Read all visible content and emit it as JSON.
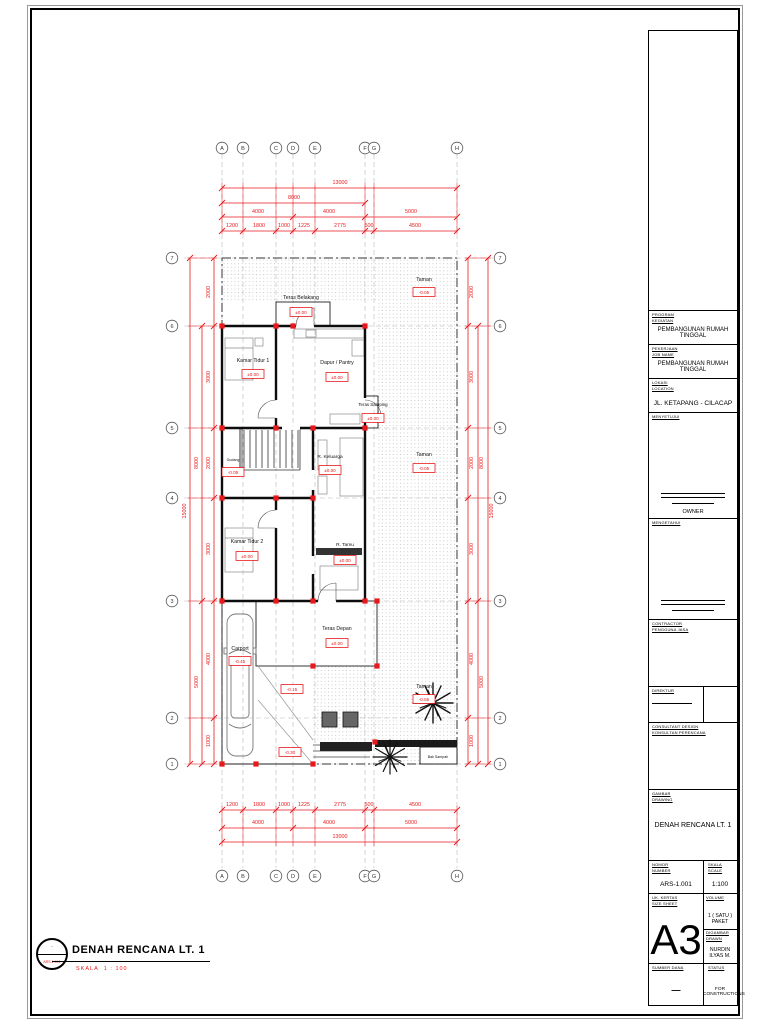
{
  "sheet": {
    "accent_red": "#e8191c",
    "paper": "#ffffff"
  },
  "footer": {
    "title": "DENAH RENCANA LT. 1",
    "scale_label": "SKALA",
    "scale_value": "1 : 100",
    "ref_top": "-",
    "ref_bottom": "ARS-1.001"
  },
  "title_block": {
    "program": {
      "label1": "PROGRAM",
      "label2": "KEGIATAN",
      "value": "PEMBANGUNAN RUMAH TINGGAL"
    },
    "pekerjaan": {
      "label1": "PEKERJAAN",
      "label2": "JOB NAME",
      "value": "PEMBANGUNAN RUMAH TINGGAL"
    },
    "lokasi": {
      "label1": "LOKASI",
      "label2": "LOCATION",
      "value": "JL. KETAPANG - CILACAP"
    },
    "menyetujui": {
      "label": "MENYETUJUI",
      "value": "OWNER"
    },
    "mengetahui": {
      "label": "MENGETAHUI"
    },
    "contractor": {
      "label1": "CONTRACTOR",
      "label2": "PENGGUNA JASA"
    },
    "direktur": {
      "label": "DIREKTUR"
    },
    "consultant": {
      "label1": "CONSULTANT DESIGN",
      "label2": "KONSULTAN PERENCANA"
    },
    "gambar": {
      "label1": "GAMBAR",
      "label2": "DRAWING",
      "value": "DENAH RENCANA LT. 1"
    },
    "nomor": {
      "label1": "NOMOR",
      "label2": "NUMBER",
      "value": "ARS-1.001"
    },
    "skala": {
      "label1": "SKALA",
      "label2": "SCALE",
      "value": "1:100"
    },
    "kertas": {
      "label1": "UK. KERTAS",
      "label2": "SIZE SHEET",
      "value": "A3"
    },
    "volume": {
      "label": "VOLUME",
      "value": "1 ( SATU ) PAKET"
    },
    "digambar": {
      "label1": "DIGAMBAR",
      "label2": "DRAWN",
      "value": "NURDIN ILYAS M."
    },
    "sumber_dana": {
      "label": "SUMBER DANA",
      "value": "—"
    },
    "status": {
      "label": "STATUS",
      "value": "FOR CONSTRUCTIONS"
    }
  },
  "plan": {
    "grid_cols": [
      "A",
      "B",
      "C",
      "D",
      "E",
      "F",
      "G",
      "H"
    ],
    "grid_rows": [
      "7",
      "6",
      "5",
      "4",
      "3",
      "2",
      "1"
    ],
    "dim_total_h": "13000",
    "dim_sub_h": "8000",
    "dims_mid_h": [
      "4000",
      "4000",
      "5000"
    ],
    "dims_detail_h": [
      "1200",
      "1800",
      "1000",
      "1225",
      "2775",
      "500",
      "4500"
    ],
    "dim_total_v": "15000",
    "dims_mid_v": [
      "8000",
      "5000"
    ],
    "dims_detail_v": [
      "2000",
      "3000",
      "2000",
      "3000",
      "4000",
      "1000"
    ],
    "rooms": {
      "teras_belakang": {
        "name": "Teras Belakang",
        "level": "±0.00"
      },
      "taman_top": {
        "name": "Taman",
        "level": "-0.05"
      },
      "kamar_tidur_1": {
        "name": "Kamar Tidur 1",
        "level": "±0.00"
      },
      "dapur": {
        "name": "Dapur / Pantry",
        "level": "±0.00"
      },
      "teras_samping": {
        "name": "Teras Samping",
        "level": "±0.00"
      },
      "gudang": {
        "name": "Gudang",
        "level": "-0.05"
      },
      "r_keluarga": {
        "name": "R. Keluarga",
        "level": "±0.00"
      },
      "taman_mid": {
        "name": "Taman",
        "level": "-0.05"
      },
      "kamar_tidur_2": {
        "name": "Kamar Tidur 2",
        "level": "±0.00"
      },
      "r_tamu": {
        "name": "R. Tamu",
        "level": "±0.00"
      },
      "teras_depan": {
        "name": "Teras Depan",
        "level": "±0.00"
      },
      "carport": {
        "name": "Carport",
        "level": "-0.45"
      },
      "taman_bottom": {
        "name": "Taman",
        "level": "-0.55"
      },
      "bak_sampah": {
        "name": "Bak Sampah"
      }
    },
    "levels": {
      "ramp_upper": "-0.15",
      "ramp_lower": "-0.30"
    }
  }
}
